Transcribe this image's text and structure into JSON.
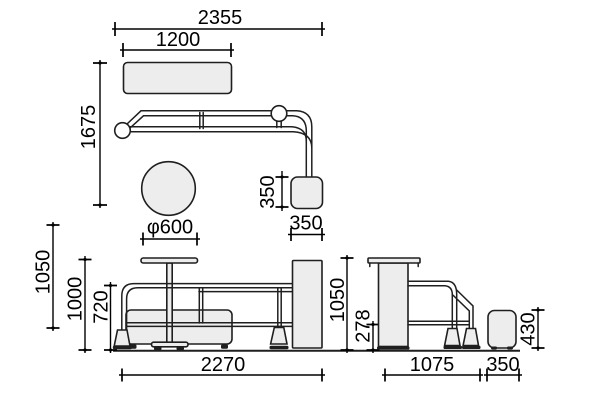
{
  "diagram": {
    "type": "furniture-dimension-drawing",
    "colors": {
      "background": "#ffffff",
      "line": "#1f1f1f",
      "panel_fill": "#ededed",
      "dimension_text": "#000000"
    },
    "views": {
      "plan": {
        "dims": {
          "overall_width": "2355",
          "bench_width": "1200",
          "overall_depth": "1675",
          "table_diameter": "φ600",
          "base_plate_depth": "350",
          "base_plate_width": "350"
        }
      },
      "front": {
        "dims": {
          "screen_height": "1050",
          "table_height": "1000",
          "rail_height": "720",
          "overall_width": "2270"
        }
      },
      "side": {
        "dims": {
          "counter_height": "1050",
          "lower_rail_height": "278",
          "depth": "1075",
          "stool_width": "350",
          "stool_height": "430"
        }
      }
    }
  }
}
